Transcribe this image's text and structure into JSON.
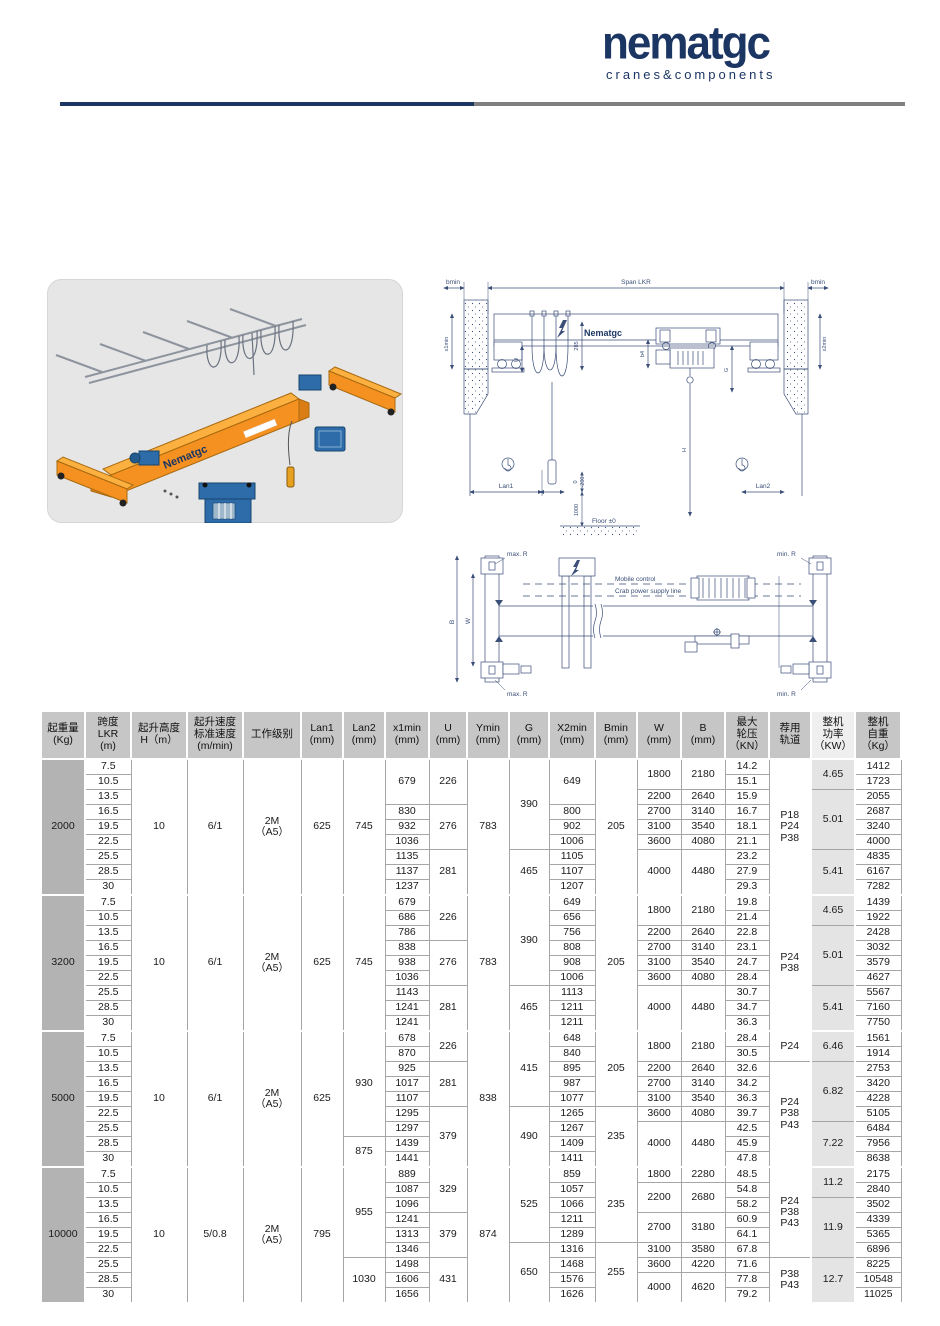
{
  "brand": {
    "name": "nematgc",
    "tagline": "cranes&components",
    "navy": "#1c3663",
    "gray": "#7f7f7f"
  },
  "drawings": {
    "iso": {
      "brand": "Nematgc"
    },
    "elevation": {
      "labels": {
        "bmin": "bmin",
        "span": "Span LKR",
        "x1min": "x1min",
        "x2min": "x2min",
        "u": "U",
        "d285": "285",
        "b4": "b4",
        "g": "G",
        "h": "H",
        "lan1": "Lan1",
        "lan2": "Lan2",
        "floor": "Floor ±0",
        "d1000": "1000",
        "d0": "0",
        "dm200": "-200",
        "logo": "Nematgc"
      }
    },
    "plan": {
      "labels": {
        "max_r": "max. R",
        "min_r": "min. R",
        "mobile": "Mobile control",
        "crab": "Crab power supply line",
        "b": "B",
        "w": "W"
      }
    }
  },
  "table": {
    "headers": [
      "起重量\n(Kg)",
      "跨度\nLKR\n(m)",
      "起升高度\nH（m）",
      "起升速度\n标准速度\n(m/min)",
      "工作级别",
      "Lan1\n(mm)",
      "Lan2\n(mm)",
      "x1min\n(mm)",
      "U\n(mm)",
      "Ymin\n(mm)",
      "G\n(mm)",
      "X2min\n(mm)",
      "Bmin\n(mm)",
      "W\n(mm)",
      "B\n(mm)",
      "最大\n轮压\n（KN）",
      "荐用\n轨道",
      "整机\n功率\n（KW）",
      "整机\n自重\n（Kg）"
    ],
    "groups": [
      {
        "rows": 9,
        "columns": [
          [
            [
              "2000",
              9
            ]
          ],
          [
            "7.5",
            "10.5",
            "13.5",
            "16.5",
            "19.5",
            "22.5",
            "25.5",
            "28.5",
            "30"
          ],
          [
            [
              "10",
              9
            ]
          ],
          [
            [
              "6/1",
              9
            ]
          ],
          [
            [
              "2M\n（A5）",
              9
            ]
          ],
          [
            [
              "625",
              9
            ]
          ],
          [
            [
              "745",
              9
            ]
          ],
          [
            [
              "679",
              3
            ],
            "830",
            "932",
            "1036",
            "1135",
            "1137",
            "1237"
          ],
          [
            [
              "226",
              3
            ],
            [
              "276",
              3
            ],
            [
              "281",
              3
            ]
          ],
          [
            [
              "783",
              9
            ]
          ],
          [
            [
              "390",
              6
            ],
            [
              "465",
              3
            ]
          ],
          [
            [
              "649",
              3
            ],
            "800",
            "902",
            "1006",
            "1105",
            "1107",
            "1207"
          ],
          [
            [
              "205",
              9
            ]
          ],
          [
            [
              "1800",
              2
            ],
            "2200",
            "2700",
            "3100",
            "3600",
            [
              "4000",
              3
            ]
          ],
          [
            [
              "2180",
              2
            ],
            "2640",
            "3140",
            "3540",
            "4080",
            [
              "4480",
              3
            ]
          ],
          [
            "14.2",
            "15.1",
            "15.9",
            "16.7",
            "18.1",
            "21.1",
            "23.2",
            "27.9",
            "29.3"
          ],
          [
            [
              "P18\nP24\nP38",
              9
            ]
          ],
          [
            [
              "4.65",
              2
            ],
            [
              "5.01",
              4
            ],
            [
              "5.41",
              3
            ]
          ],
          [
            "1412",
            "1723",
            "2055",
            "2687",
            "3240",
            "4000",
            "4835",
            "6167",
            "7282"
          ]
        ]
      },
      {
        "rows": 9,
        "columns": [
          [
            [
              "3200",
              9
            ]
          ],
          [
            "7.5",
            "10.5",
            "13.5",
            "16.5",
            "19.5",
            "22.5",
            "25.5",
            "28.5",
            "30"
          ],
          [
            [
              "10",
              9
            ]
          ],
          [
            [
              "6/1",
              9
            ]
          ],
          [
            [
              "2M\n（A5）",
              9
            ]
          ],
          [
            [
              "625",
              9
            ]
          ],
          [
            [
              "745",
              9
            ]
          ],
          [
            "679",
            "686",
            "786",
            "838",
            "938",
            "1036",
            "1143",
            "1241",
            "1241"
          ],
          [
            [
              "226",
              3
            ],
            [
              "276",
              3
            ],
            [
              "281",
              3
            ]
          ],
          [
            [
              "783",
              9
            ]
          ],
          [
            [
              "390",
              6
            ],
            [
              "465",
              3
            ]
          ],
          [
            "649",
            "656",
            "756",
            "808",
            "908",
            "1006",
            "1113",
            "1211",
            "1211"
          ],
          [
            [
              "205",
              9
            ]
          ],
          [
            [
              "1800",
              2
            ],
            "2200",
            "2700",
            "3100",
            "3600",
            [
              "4000",
              3
            ]
          ],
          [
            [
              "2180",
              2
            ],
            "2640",
            "3140",
            "3540",
            "4080",
            [
              "4480",
              3
            ]
          ],
          [
            "19.8",
            "21.4",
            "22.8",
            "23.1",
            "24.7",
            "28.4",
            "30.7",
            "34.7",
            "36.3"
          ],
          [
            [
              "P24\nP38",
              9
            ]
          ],
          [
            [
              "4.65",
              2
            ],
            [
              "5.01",
              4
            ],
            [
              "5.41",
              3
            ]
          ],
          [
            "1439",
            "1922",
            "2428",
            "3032",
            "3579",
            "4627",
            "5567",
            "7160",
            "7750"
          ]
        ]
      },
      {
        "rows": 9,
        "columns": [
          [
            [
              "5000",
              9
            ]
          ],
          [
            "7.5",
            "10.5",
            "13.5",
            "16.5",
            "19.5",
            "22.5",
            "25.5",
            "28.5",
            "30"
          ],
          [
            [
              "10",
              9
            ]
          ],
          [
            [
              "6/1",
              9
            ]
          ],
          [
            [
              "2M\n（A5）",
              9
            ]
          ],
          [
            [
              "625",
              9
            ]
          ],
          [
            [
              "930",
              7
            ],
            [
              "875",
              2
            ]
          ],
          [
            "678",
            "870",
            "925",
            "1017",
            "1107",
            "1295",
            "1297",
            "1439",
            "1441"
          ],
          [
            [
              "226",
              2
            ],
            [
              "281",
              3
            ],
            [
              "379",
              4
            ]
          ],
          [
            [
              "838",
              9
            ]
          ],
          [
            [
              "415",
              5
            ],
            [
              "490",
              4
            ]
          ],
          [
            "648",
            "840",
            "895",
            "987",
            "1077",
            "1265",
            "1267",
            "1409",
            "1411"
          ],
          [
            [
              "205",
              5
            ],
            [
              "235",
              4
            ]
          ],
          [
            [
              "1800",
              2
            ],
            "2200",
            "2700",
            "3100",
            "3600",
            [
              "4000",
              3
            ]
          ],
          [
            [
              "2180",
              2
            ],
            "2640",
            "3140",
            "3540",
            "4080",
            [
              "4480",
              3
            ]
          ],
          [
            "28.4",
            "30.5",
            "32.6",
            "34.2",
            "36.3",
            "39.7",
            "42.5",
            "45.9",
            "47.8"
          ],
          [
            [
              "P24",
              2
            ],
            [
              "P24\nP38\nP43",
              7
            ]
          ],
          [
            [
              "6.46",
              2
            ],
            [
              "6.82",
              4
            ],
            [
              "7.22",
              3
            ]
          ],
          [
            "1561",
            "1914",
            "2753",
            "3420",
            "4228",
            "5105",
            "6484",
            "7956",
            "8638"
          ]
        ]
      },
      {
        "rows": 9,
        "columns": [
          [
            [
              "10000",
              9
            ]
          ],
          [
            "7.5",
            "10.5",
            "13.5",
            "16.5",
            "19.5",
            "22.5",
            "25.5",
            "28.5",
            "30"
          ],
          [
            [
              "10",
              9
            ]
          ],
          [
            [
              "5/0.8",
              9
            ]
          ],
          [
            [
              "2M\n（A5）",
              9
            ]
          ],
          [
            [
              "795",
              9
            ]
          ],
          [
            [
              "955",
              6
            ],
            [
              "1030",
              3
            ]
          ],
          [
            "889",
            "1087",
            "1096",
            "1241",
            "1313",
            "1346",
            "1498",
            "1606",
            "1656"
          ],
          [
            [
              "329",
              3
            ],
            [
              "379",
              3
            ],
            [
              "431",
              3
            ]
          ],
          [
            [
              "874",
              9
            ]
          ],
          [
            [
              "525",
              5
            ],
            [
              "650",
              4
            ]
          ],
          [
            "859",
            "1057",
            "1066",
            "1211",
            "1289",
            "1316",
            "1468",
            "1576",
            "1626"
          ],
          [
            [
              "235",
              5
            ],
            [
              "255",
              4
            ]
          ],
          [
            "1800",
            [
              "2200",
              2
            ],
            [
              "2700",
              2
            ],
            "3100",
            "3600",
            [
              "4000",
              2
            ]
          ],
          [
            "2280",
            [
              "2680",
              2
            ],
            [
              "3180",
              2
            ],
            "3580",
            "4220",
            [
              "4620",
              2
            ]
          ],
          [
            "48.5",
            "54.8",
            "58.2",
            "60.9",
            "64.1",
            "67.8",
            "71.6",
            "77.8",
            "79.2"
          ],
          [
            [
              "P24\nP38\nP43",
              6
            ],
            [
              "P38\nP43",
              3
            ]
          ],
          [
            [
              "11.2",
              2
            ],
            [
              "11.9",
              4
            ],
            [
              "12.7",
              3
            ]
          ],
          [
            "2175",
            "2840",
            "3502",
            "4339",
            "5365",
            "6896",
            "8225",
            "10548",
            "11025"
          ]
        ]
      }
    ]
  }
}
